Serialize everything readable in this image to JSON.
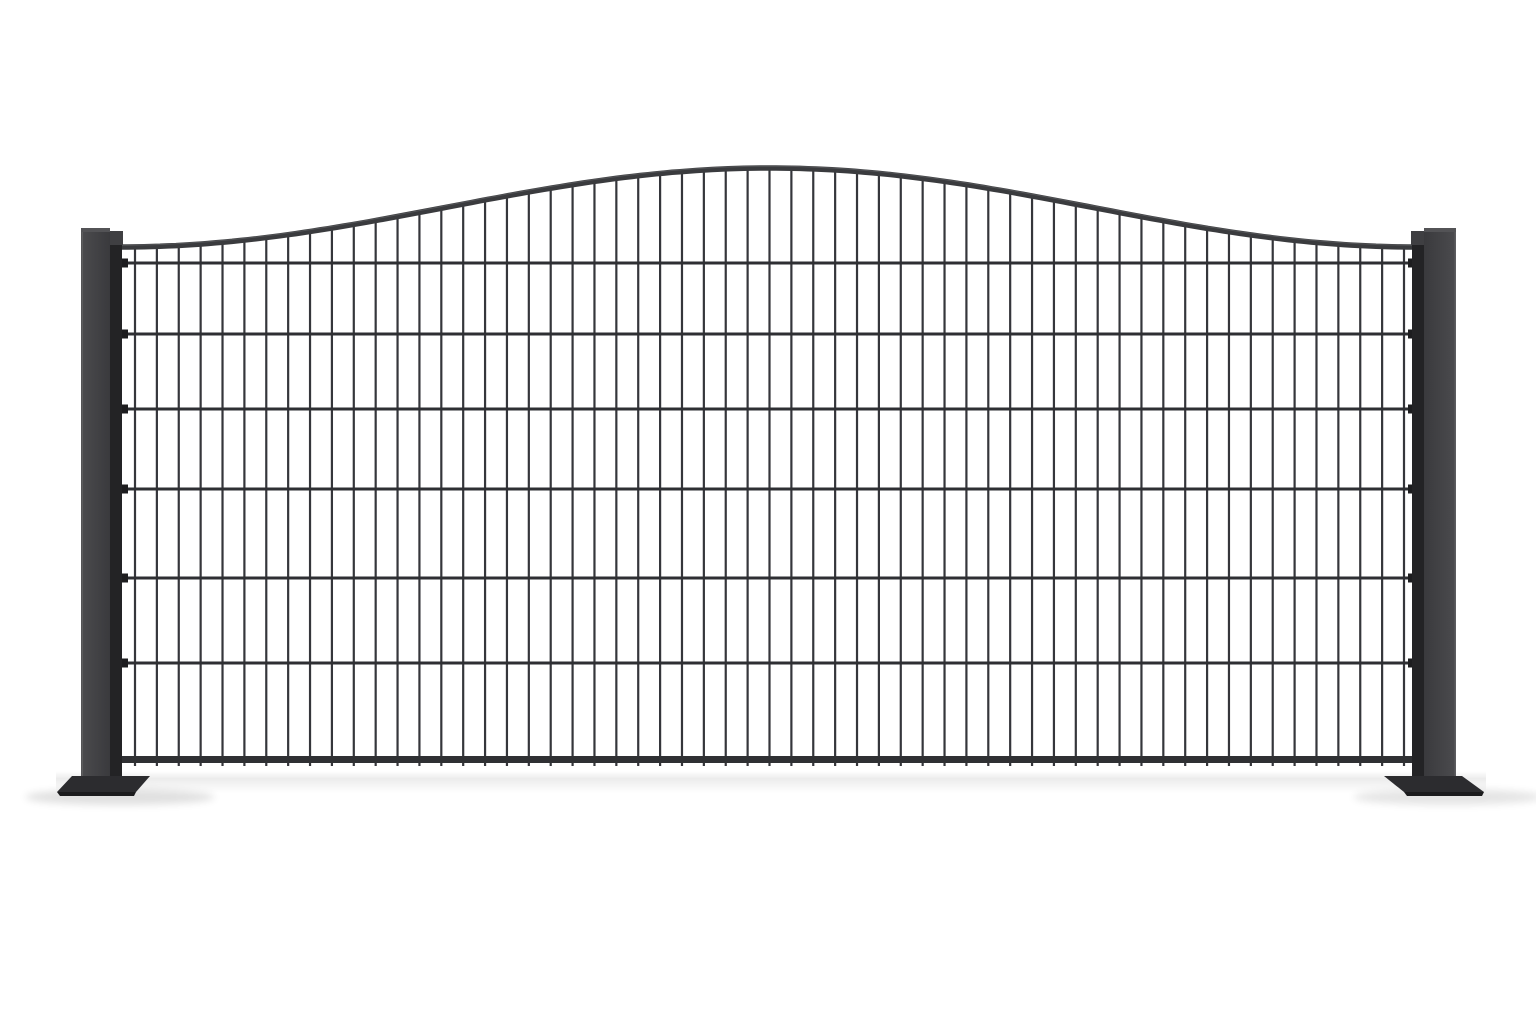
{
  "image": {
    "description": "Product render of an anthracite double-rod wire mesh fence panel with a convex arched top, mounted between two square posts on flat base plates, on a plain white background with a soft ground shadow",
    "background_color": "#ffffff"
  },
  "palette": {
    "background": "#ffffff",
    "post_outer": "#4b4b4e",
    "post_inner": "#3a3a3d",
    "post_edge_highlight": "#6b6b6d",
    "post_cap": "#535356",
    "cap_lip": "#3f3f42",
    "connector_strip": "#232325",
    "connector_nub": "#1d1d1f",
    "vertical_wire": "#35363b",
    "horizontal_wire": "#2e2f33",
    "bottom_rail": "#2f3033",
    "arch_bar": "#3a3b3e",
    "arch_highlight": "#5a5b5e",
    "base_plate_top": "#2c2c2f",
    "base_plate_edge": "#1b1b1d",
    "shadow_color": "#000000"
  },
  "scene": {
    "canvas": {
      "width": 1536,
      "height": 1024
    },
    "posts": {
      "top_y": 228,
      "bottom_y": 788,
      "cap_height": 4,
      "cap_lip": {
        "width": 13,
        "height": 14,
        "y": 231
      },
      "strip_width": 12,
      "strip_top_y": 243,
      "left": {
        "face_x": 81,
        "face_width": 29,
        "strip_x": 110,
        "highlight_x": 81.5
      },
      "right": {
        "face_x": 1424,
        "face_width": 32,
        "strip_x": 1412,
        "highlight_x": 1454.5
      }
    },
    "base_plates": {
      "left": {
        "top_face": [
          [
            72,
            776
          ],
          [
            150,
            776
          ],
          [
            136,
            792
          ],
          [
            57,
            792
          ]
        ],
        "front_edge": [
          [
            57,
            792
          ],
          [
            136,
            792
          ],
          [
            134,
            796
          ],
          [
            60,
            796
          ]
        ]
      },
      "right": {
        "top_face": [
          [
            1384,
            776
          ],
          [
            1462,
            776
          ],
          [
            1484,
            792
          ],
          [
            1404,
            792
          ]
        ],
        "front_edge": [
          [
            1404,
            792
          ],
          [
            1484,
            792
          ],
          [
            1482,
            796
          ],
          [
            1407,
            796
          ]
        ]
      }
    },
    "mesh": {
      "left_x": 122,
      "right_x": 1414,
      "wire_first_x": 135,
      "wire_last_x": 1404,
      "vertical_wire_count": 59,
      "vertical_wire_width": 2.2,
      "horizontal_rows_y": [
        263,
        334,
        409,
        489,
        578,
        663
      ],
      "horizontal_wire_height": 3,
      "bottom_rail_y": 756,
      "bottom_rail_height": 7,
      "wire_bottom_y": 766,
      "nub": {
        "width": 16,
        "height": 9,
        "left_x": 112,
        "right_x": 1408
      }
    },
    "arch": {
      "left_x": 120,
      "right_x": 1416,
      "apex_x": 770,
      "apex_y": 168,
      "end_y": 247,
      "bar_thickness": 5.5,
      "sample_step": 8
    },
    "shadow": {
      "band": {
        "x": 56,
        "y": 771,
        "width": 1430,
        "height": 22,
        "peak_opacity": 0.075
      },
      "left_pool": {
        "cx": 120,
        "cy": 797,
        "rx": 95,
        "ry": 8,
        "opacity": 0.12
      },
      "right_pool": {
        "cx": 1448,
        "cy": 797,
        "rx": 95,
        "ry": 8,
        "opacity": 0.1
      }
    }
  }
}
